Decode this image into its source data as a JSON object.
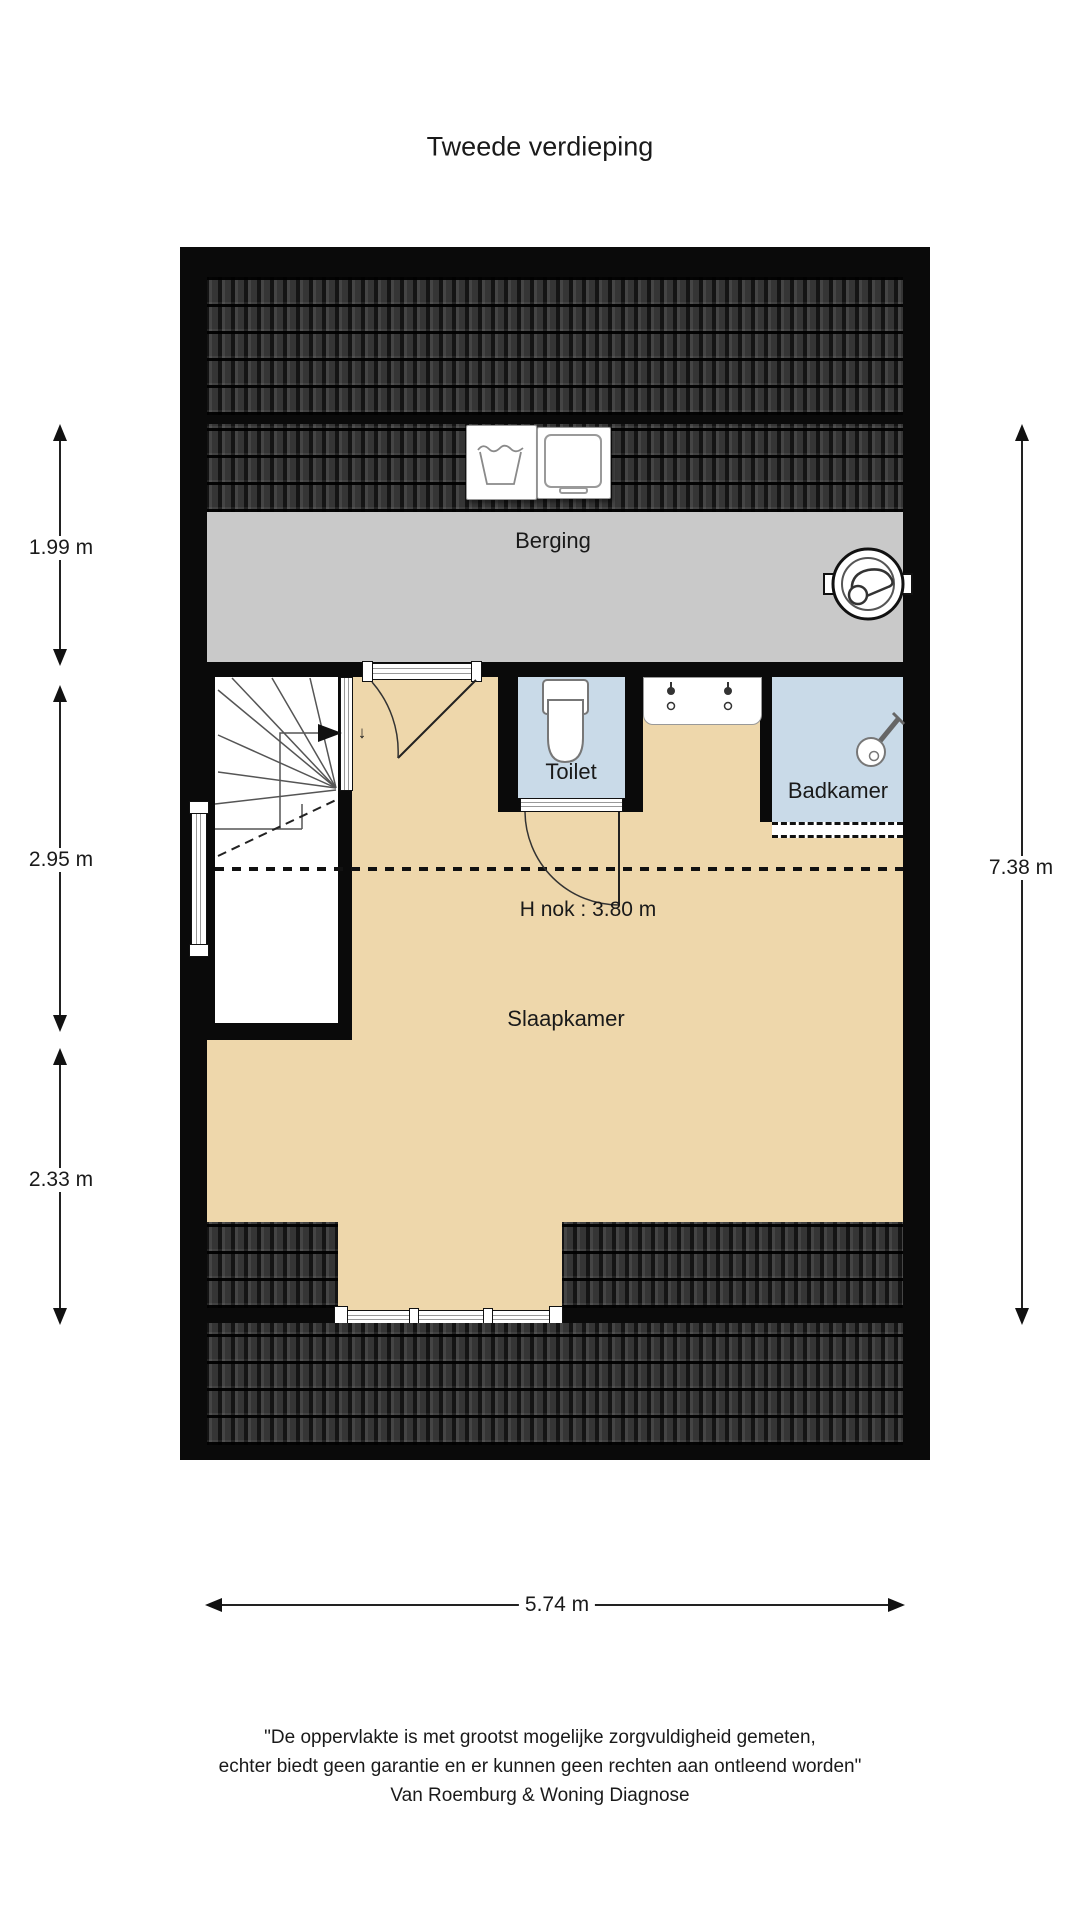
{
  "title": "Tweede verdieping",
  "rooms": {
    "berging": "Berging",
    "toilet": "Toilet",
    "badkamer": "Badkamer",
    "slaapkamer": "Slaapkamer"
  },
  "labels": {
    "h_nok": "H nok : 3.80 m",
    "stairs_down_arrow": "↓"
  },
  "dimensions": {
    "left": [
      {
        "value": "1.99 m"
      },
      {
        "value": "2.95 m"
      },
      {
        "value": "2.33 m"
      }
    ],
    "right": {
      "value": "7.38 m"
    },
    "bottom": {
      "value": "5.74 m"
    }
  },
  "disclaimer": {
    "line1": "\"De oppervlakte is met grootst mogelijke zorgvuldigheid gemeten,",
    "line2": "echter biedt geen garantie en er kunnen geen rechten aan ontleend worden\"",
    "line3": "Van Roemburg & Woning Diagnose"
  },
  "colors": {
    "wall": "#0a0a0a",
    "roof_tile": "#2b2b2b",
    "storage_gray": "#c9c9c9",
    "floor_beige": "#eed7ab",
    "wet_room_blue": "#c9dae8"
  },
  "icons": {
    "washing_machine": "wash-tub symbol",
    "dryer": "rounded square symbol",
    "mechanical_ventilation": "round unit with impeller",
    "shower": "shower head with handle",
    "toilet": "bowl with cistern",
    "washbasin": "counter with two taps"
  }
}
